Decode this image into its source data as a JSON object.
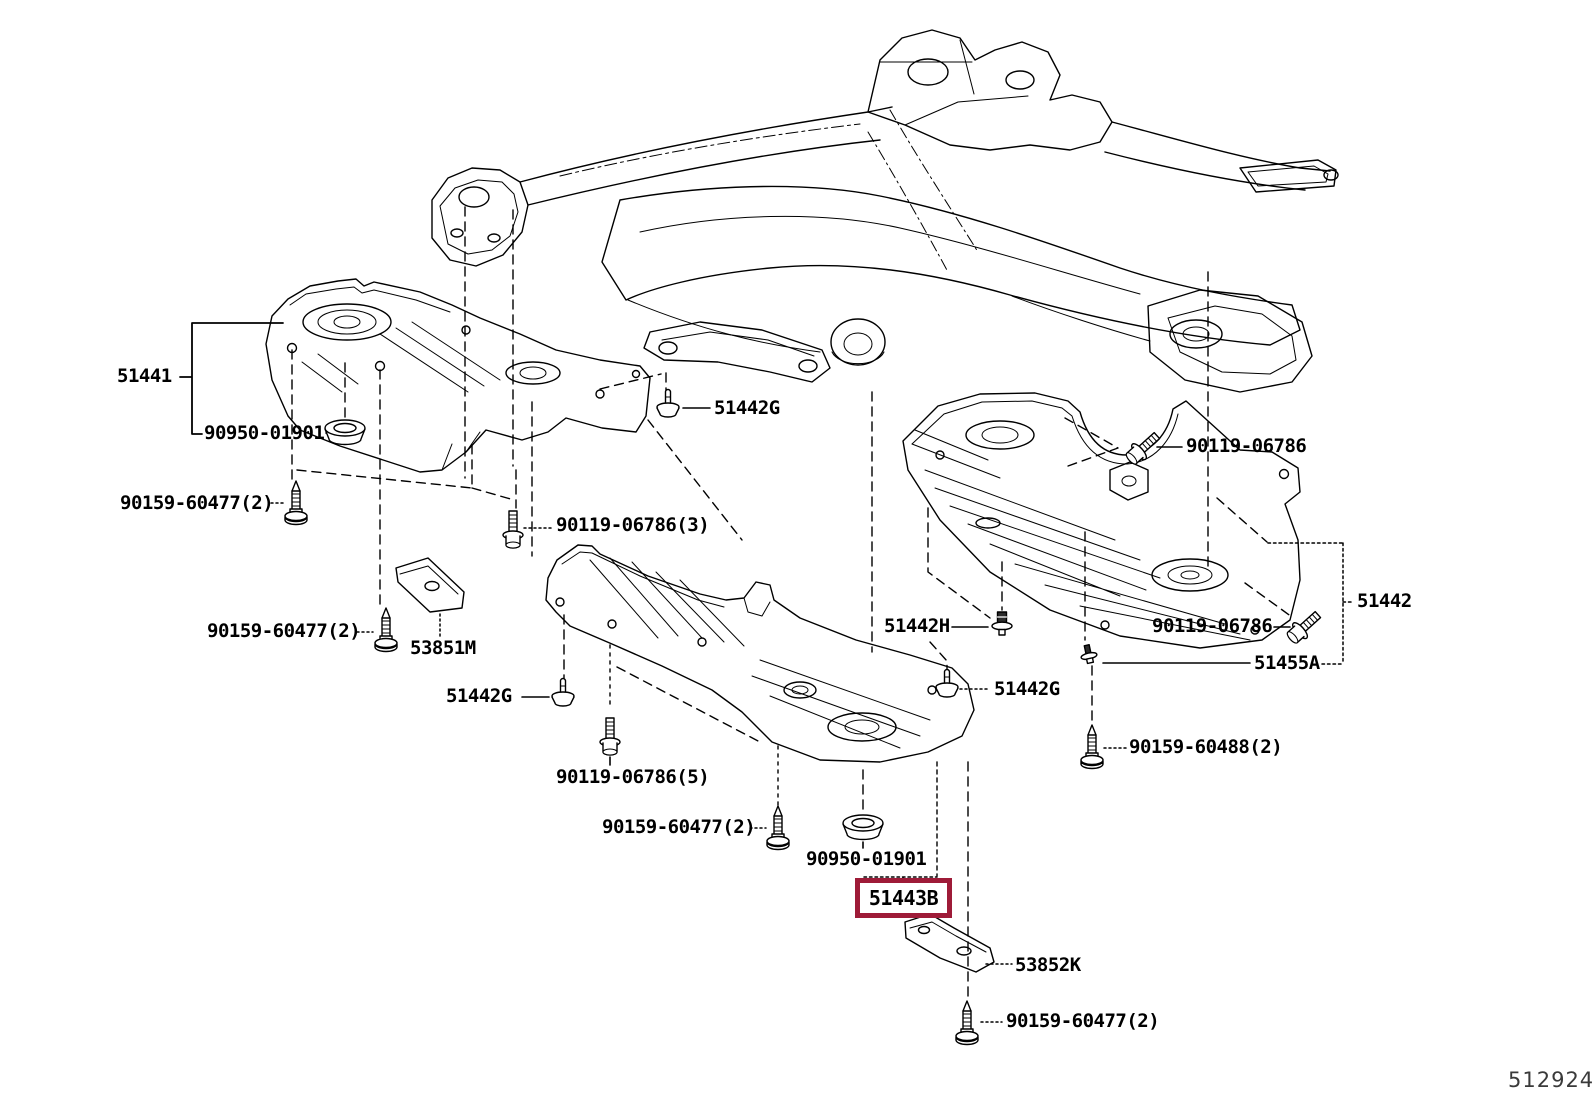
{
  "figure": {
    "code": "512924"
  },
  "colors": {
    "line": "#000000",
    "highlight": "#9e1b38",
    "background": "#ffffff"
  },
  "labels": {
    "cover_front_lh": "51441",
    "grommet_upper": "90950-01901",
    "screw_front_lh": "90159-60477(2)",
    "clip_upper_center": "51442G",
    "bolt_front_lh": "90119-06786(3)",
    "screw_stay_lh": "90159-60477(2)",
    "stay_front_lh": "53851M",
    "clip_front_lh": "51442G",
    "bolt_rear_rh_upper": "90119-06786",
    "clip_center": "51442H",
    "clip_center_rh": "51442G",
    "cover_engine_rh": "51442",
    "bolt_rear_rh_lower": "90119-06786",
    "clip_rear_rh": "51455A",
    "screw_rear_rh": "90159-60488(2)",
    "bolt_center": "90119-06786(5)",
    "screw_center": "90159-60477(2)",
    "grommet_lower": "90950-01901",
    "part_highlighted": "51443B",
    "stay_center": "53852K",
    "screw_bottom": "90159-60477(2)"
  }
}
